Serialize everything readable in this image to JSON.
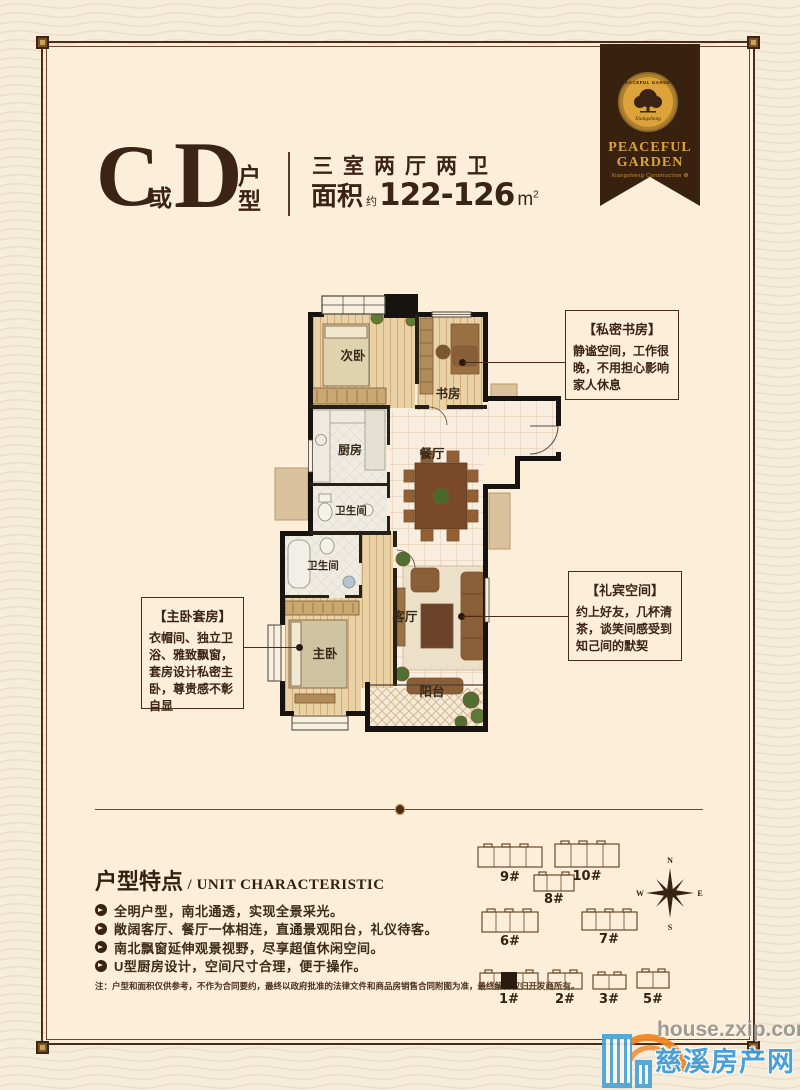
{
  "header": {
    "big_c": "C",
    "conj": "或",
    "big_d": "D",
    "suffix_top": "户",
    "suffix_bottom": "型",
    "layout_text": "三室两厅两卫",
    "area_label": "面积",
    "area_approx": "约",
    "area_value": "122-126",
    "area_unit": "m",
    "area_sup": "2"
  },
  "ribbon": {
    "seal_arc": "PEACEFUL GARDEN",
    "seal_script": "Xiangsheng",
    "line1": "PEACEFUL",
    "line2": "GARDEN",
    "sub": "Xiangsheng Construction ❂"
  },
  "plan": {
    "rooms": {
      "bedroom2": "次卧",
      "study": "书房",
      "kitchen": "厨房",
      "dining": "餐厅",
      "bath1": "卫生间",
      "bath2": "卫生间",
      "master": "主卧",
      "living": "客厅",
      "balcony": "阳台"
    }
  },
  "callouts": {
    "study": {
      "title": "【私密书房】",
      "body": "静谧空间，工作很晚，不用担心影响家人休息"
    },
    "master": {
      "title": "【主卧套房】",
      "body": "衣帽间、独立卫浴、雅致飘窗，套房设计私密主卧，尊贵感不彰自显"
    },
    "guest": {
      "title": "【礼宾空间】",
      "body": "约上好友，几杯清茶，谈笑间感受到知己间的默契"
    }
  },
  "features": {
    "title_cn": "户型特点",
    "slash": "/",
    "title_en": "UNIT CHARACTERISTIC",
    "items": [
      "全明户型，南北通透，实现全景采光。",
      "敞阔客厅、餐厅一体相连，直通景观阳台，礼仪待客。",
      "南北飘窗延伸观景视野，尽享超值休闲空间。",
      "U型厨房设计，空间尺寸合理，便于操作。"
    ],
    "note": "注：户型和面积仅供参考，不作为合同要约，最终以政府批准的法律文件和商品房销售合同附图为准，最终解释权归开发商所有。"
  },
  "siteplan": {
    "buildings": [
      {
        "label": "9#"
      },
      {
        "label": "10#"
      },
      {
        "label": "8#"
      },
      {
        "label": "6#"
      },
      {
        "label": "7#"
      },
      {
        "label": "1#",
        "highlighted": true
      },
      {
        "label": "2#"
      },
      {
        "label": "3#"
      },
      {
        "label": "5#"
      }
    ],
    "compass": {
      "n": "N",
      "s": "S",
      "e": "E",
      "w": "W"
    }
  },
  "watermark": {
    "line1": "house.zxip.com",
    "line2": "慈溪房产网"
  },
  "colors": {
    "accent_brown": "#3b2315",
    "panel_bg": "#fdeeda",
    "ribbon_bg": "#38220f",
    "gold": "#dba33a",
    "wall_black": "#171310",
    "wm_blue": "#3e9bd6",
    "wm_orange": "#ef8522",
    "wm_gray": "#98948b"
  }
}
